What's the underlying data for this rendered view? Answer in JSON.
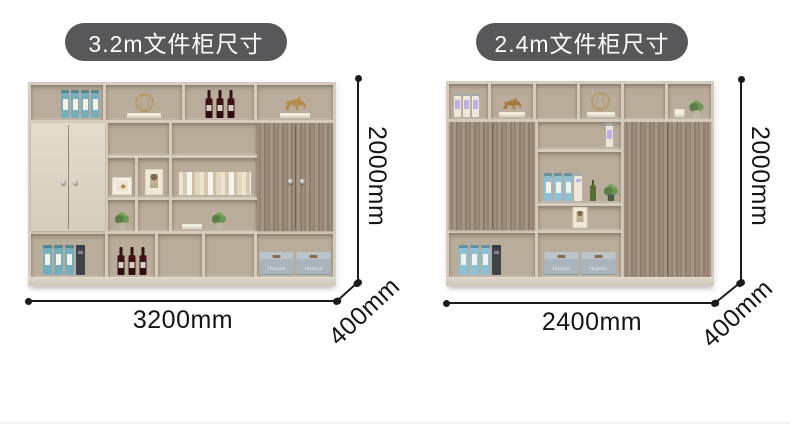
{
  "page": {
    "background": "#ffffff"
  },
  "panels": [
    {
      "badge": "3.2m文件柜尺寸",
      "width_label": "3200mm",
      "height_label": "2000mm",
      "depth_label": "400mm"
    },
    {
      "badge": "2.4m文件柜尺寸",
      "width_label": "2400mm",
      "height_label": "2000mm",
      "depth_label": "400mm"
    }
  ],
  "decor": {
    "box_label": "TRUCKS"
  },
  "colors": {
    "badge_bg": "#58585a",
    "badge_text": "#ffffff",
    "dimension_line": "#1b1b1b",
    "frame": "#d5ccbd",
    "interior": "#b9ac9a",
    "wood_door": "#9a8a7a",
    "cream_door": "#ded6c7",
    "binder_teal": "#72aebc",
    "binder_blue": "#8cc0d6",
    "storage_box": "#a9b4bd"
  }
}
